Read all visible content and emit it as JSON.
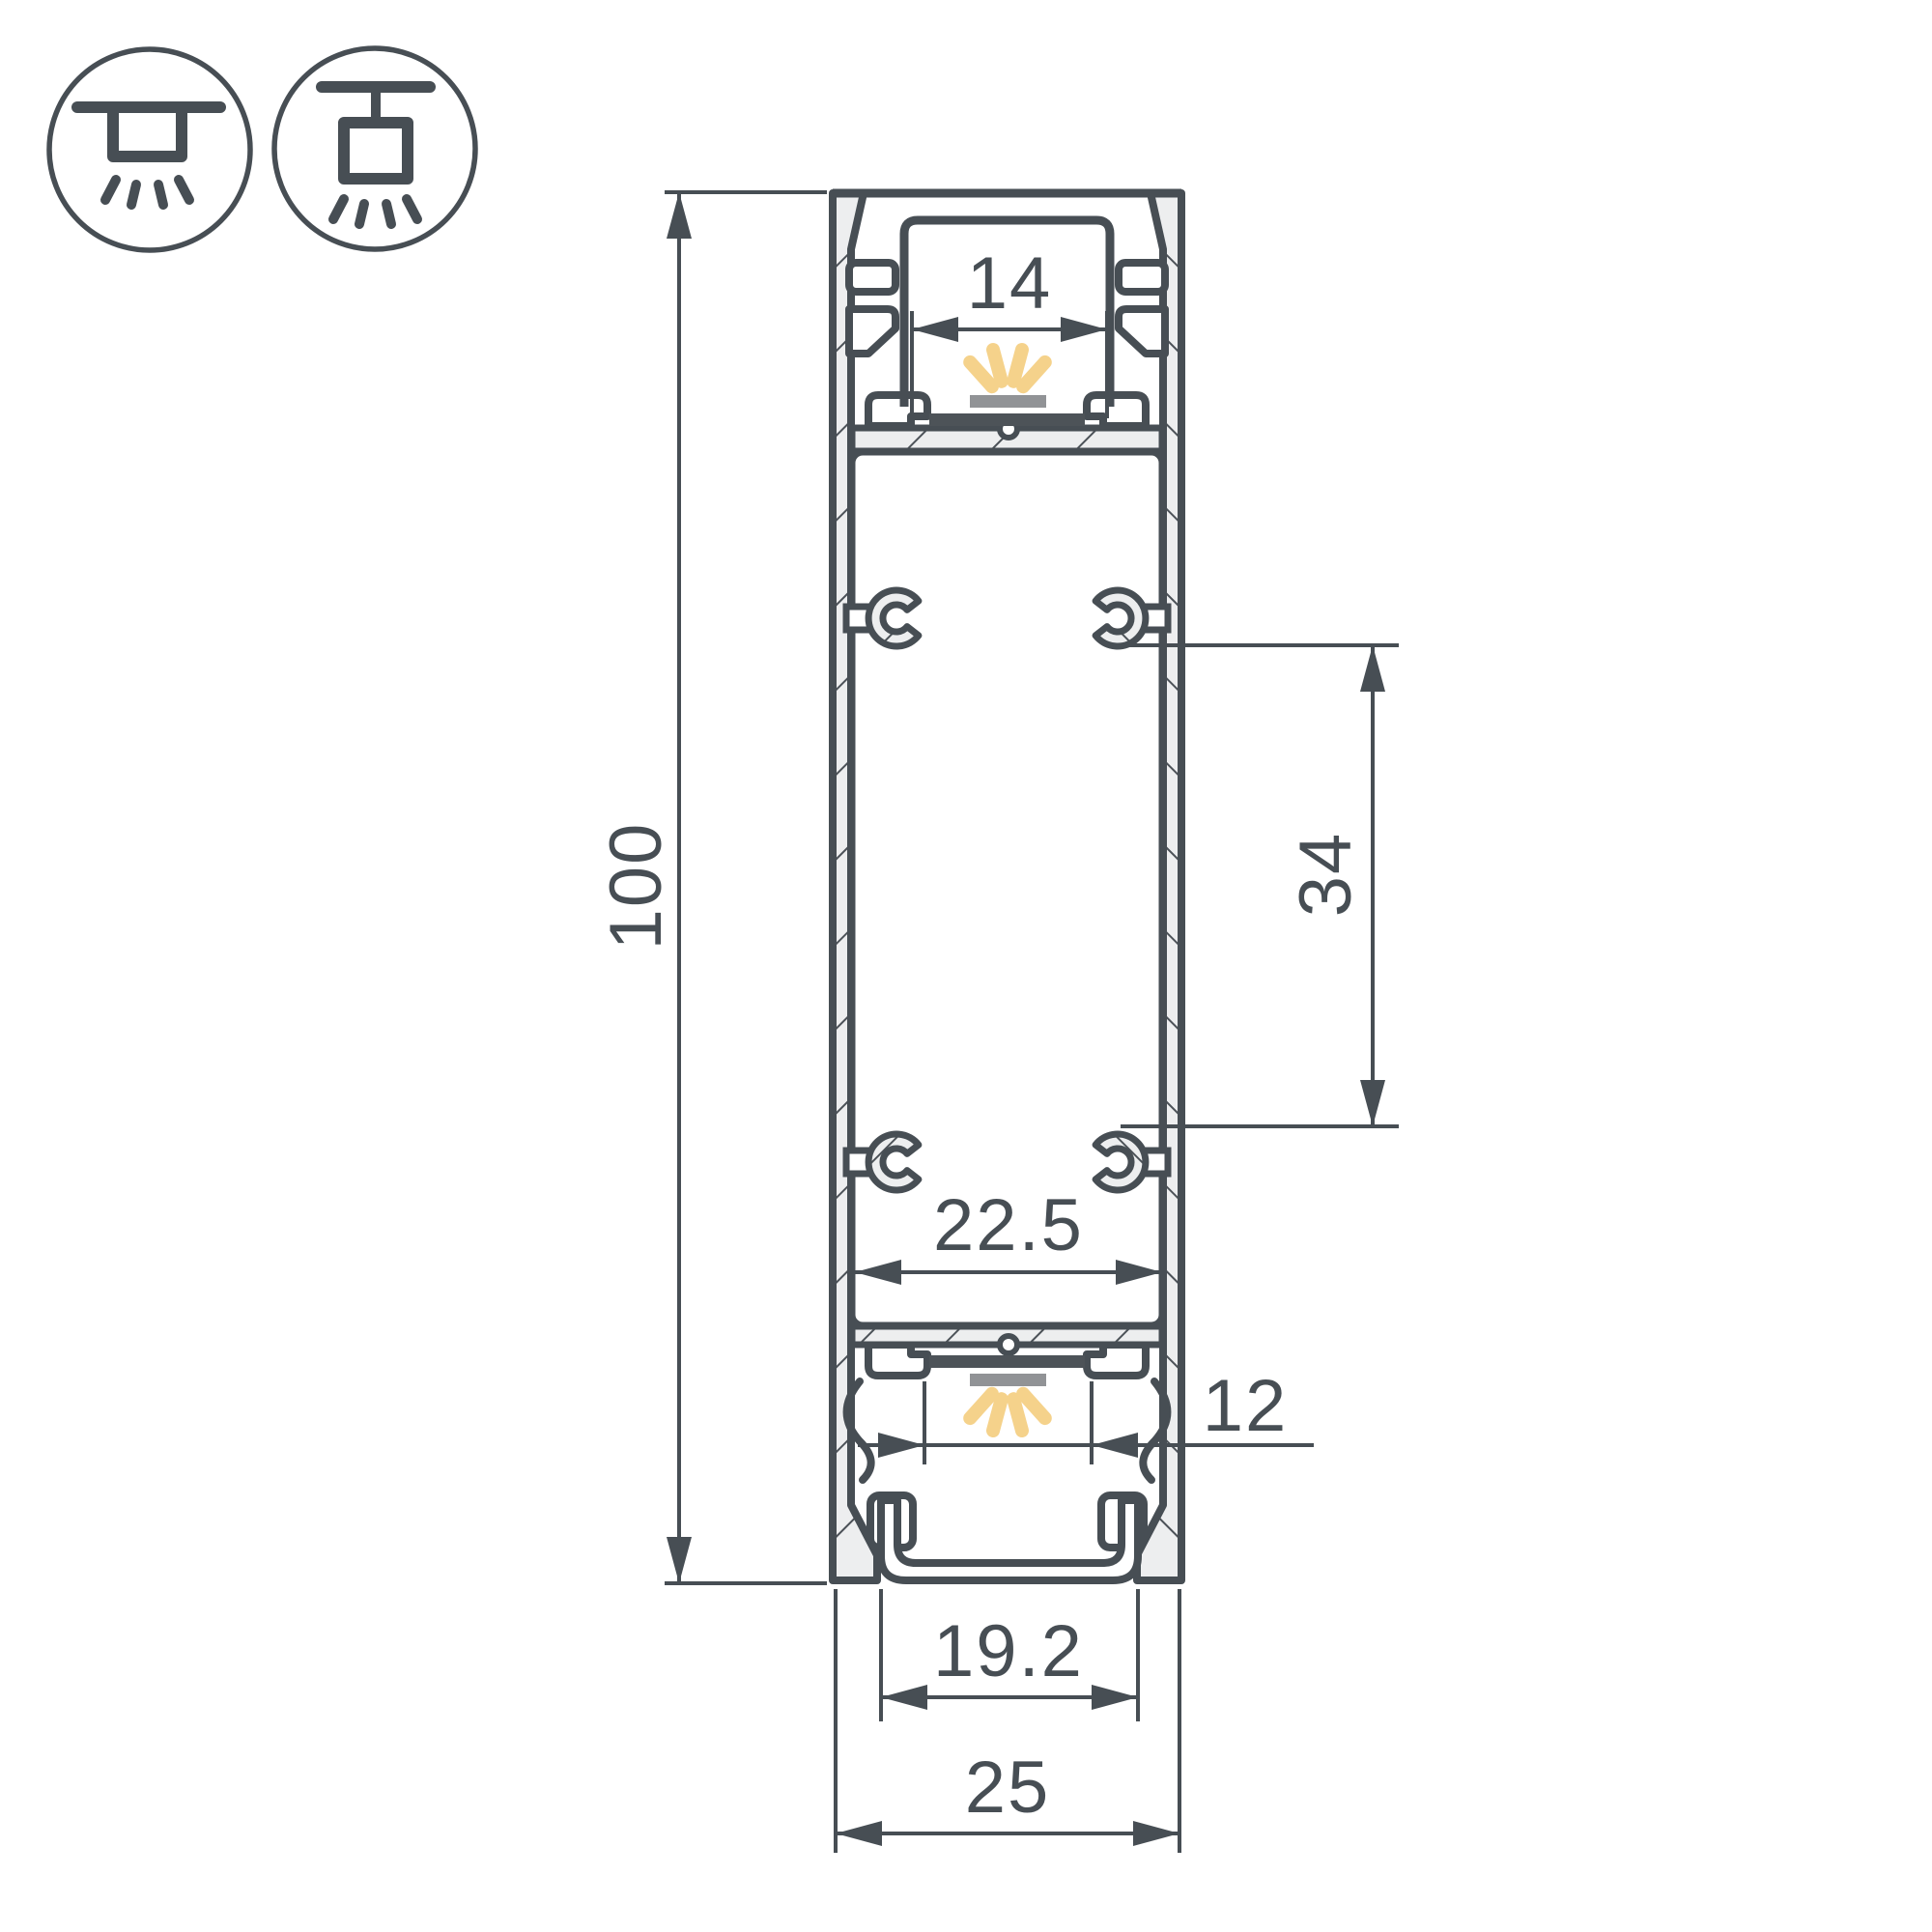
{
  "drawing": {
    "kind": "led-profile-cross-section-technical-drawing",
    "mount_icons": [
      {
        "name": "ceiling-surface-mount-icon"
      },
      {
        "name": "ceiling-pendant-mount-icon"
      }
    ],
    "dimension_labels": {
      "total_height": "100",
      "top_window_width": "14",
      "boss_spacing": "34",
      "inner_width": "22.5",
      "bottom_window_width": "12",
      "diffuser_width": "19.2",
      "total_width": "25"
    },
    "colors": {
      "outline": "#474e54",
      "hatch_line": "#4c5258",
      "wall_fill": "#edeeef",
      "led_ray": "#f5d28b",
      "led_bar": "#919396",
      "pcb_bar": "#4d5358",
      "background": "#ffffff"
    }
  }
}
